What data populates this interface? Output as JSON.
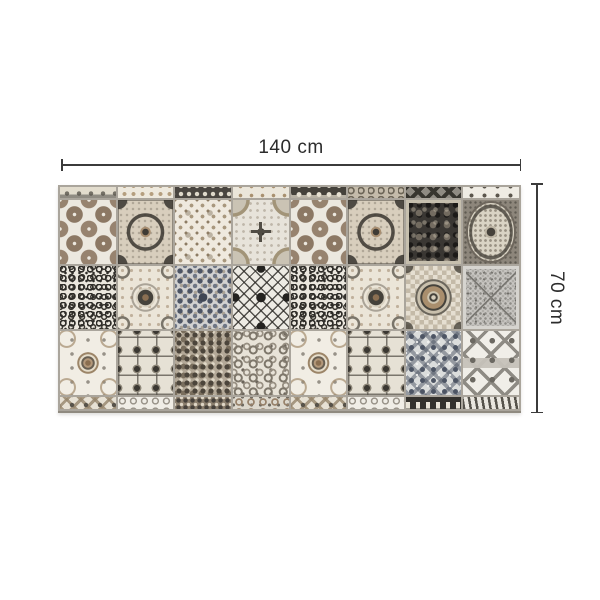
{
  "figure": {
    "type": "product dimension diagram",
    "subject": "patchwork azulejo tile vinyl rug, grayscale and tan",
    "width_label": "140 cm",
    "height_label": "70 cm"
  },
  "palette": {
    "background": "#ffffff",
    "annotation_line": "#3b3b3b",
    "annotation_text": "#2c2c2c",
    "grout": "#aaa59c",
    "tile_cream": "#ece8df",
    "tile_brown": "#8c7864",
    "tile_charcoal": "#3a3733",
    "tile_blue_gray": "#4c5464"
  },
  "mat": {
    "columns": 8,
    "full_rows": 3,
    "top_strip": [
      "ts1",
      "ts2",
      "ts3",
      "ts4",
      "ts5",
      "ts6",
      "ts7",
      "ts8"
    ],
    "rows": [
      [
        "circles",
        "ornate-frame",
        "floral-lattice",
        "circle-cross",
        "circles",
        "ornate-frame",
        "dark-damask",
        "lace-medallion"
      ],
      [
        "scroll-vine",
        "sunflower",
        "kaleidoscope",
        "argyle",
        "scroll-vine",
        "sunflower",
        "target-medallion",
        "speckled-x"
      ],
      [
        "rococo",
        "gem-frames",
        "dense-floral",
        "paisley",
        "rococo",
        "gem-frames",
        "diamond-damask",
        "quatrefoil-trellis"
      ]
    ],
    "bottom_strip": [
      "bs1",
      "bs2",
      "bs3",
      "bs4",
      "bs1",
      "bs2",
      "bs7",
      "bs8"
    ],
    "pattern_names": {
      "circles": "tan circular medallions on cream",
      "ornate-frame": "dark cushion frame with corner flourishes on beige",
      "floral-lattice": "fine taupe floral lattice on cream",
      "circle-cross": "corner quarter-circle arcs with central dark cross",
      "dark-damask": "charcoal damask with light speckled border",
      "lace-medallion": "cream lace oval medallion on warm gray",
      "scroll-vine": "dense black scrolling vines on white",
      "sunflower": "central rosette with curled dark fronds",
      "kaleidoscope": "dense blue-gray kaleidoscope floral",
      "argyle": "black diamond lattice with edge triangles",
      "target-medallion": "concentric ring medallion with tan band over checker",
      "speckled-x": "gray granito speckle with diagonal cross",
      "rococo": "rococo C-scrolls around round brown rosette",
      "gem-frames": "paneled square frames with diamond gems",
      "dense-floral": "dense brown-gray floret field",
      "paisley": "scattered gray paisley curls on cream",
      "diamond-damask": "blue-gray diamond damask lattice",
      "quatrefoil-trellis": "gray quatrefoil trellis with center band",
      "ts1": "light strip with dark swirl fragments and gray band",
      "ts2": "cream strip with tan petal dots",
      "ts3": "dark strip with white florets",
      "ts4": "cream strip with sparse tan sprigs",
      "ts5": "black strip with white flower dots",
      "ts6": "taupe strip with scroll curls",
      "ts7": "gray strip with dark chevrons",
      "ts8": "light strip with sparse dark motifs",
      "bs1": "beige zigzag chevron strip with leaf dots",
      "bs2": "white strip with gray scroll speckle",
      "bs3": "brown dense speckle strip",
      "bs4": "light strip with round medallion speckle",
      "bs7": "black strip with white crenellated motifs",
      "bs8": "cream strip with dark zebra lines"
    }
  }
}
